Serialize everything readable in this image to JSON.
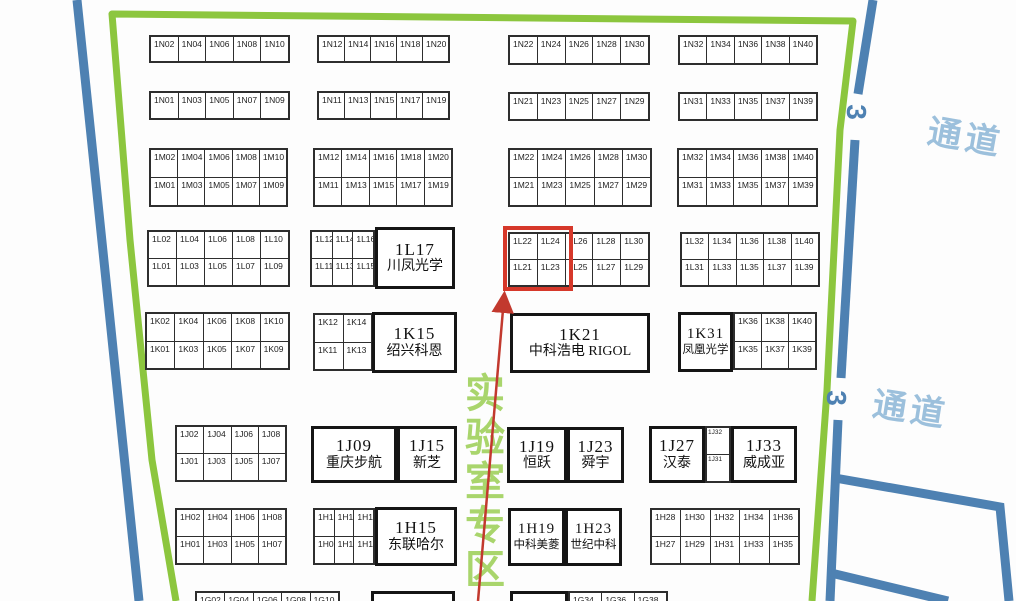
{
  "colors": {
    "border_green": "#8CC63E",
    "zone_green": "#A9D56C",
    "aisle_blue": "#4E81B2",
    "aisle_text_blue": "#9CC0DC",
    "highlight_red": "#D6382A",
    "arrow_red": "#C2392E",
    "booth_border": "#2E2E2E"
  },
  "zone": {
    "text": "实验室专区"
  },
  "aisles": [
    {
      "text": "通道"
    },
    {
      "text": "通道"
    }
  ],
  "gates": [
    {
      "text": "3"
    },
    {
      "text": "3"
    }
  ],
  "highlight": {
    "booths": [
      "1L21",
      "1L22",
      "1L23",
      "1L24"
    ]
  },
  "blocks": [
    {
      "x": 149,
      "y": 35,
      "w": 141,
      "h": 28,
      "rows": [
        [
          "1N02",
          "1N04",
          "1N06",
          "1N08",
          "1N10"
        ]
      ]
    },
    {
      "x": 317,
      "y": 35,
      "w": 133,
      "h": 28,
      "rows": [
        [
          "1N12",
          "1N14",
          "1N16",
          "1N18",
          "1N20"
        ]
      ]
    },
    {
      "x": 508,
      "y": 35,
      "w": 142,
      "h": 30,
      "rows": [
        [
          "1N22",
          "1N24",
          "1N26",
          "1N28",
          "1N30"
        ]
      ]
    },
    {
      "x": 678,
      "y": 35,
      "w": 140,
      "h": 30,
      "rows": [
        [
          "1N32",
          "1N34",
          "1N36",
          "1N38",
          "1N40"
        ]
      ]
    },
    {
      "x": 149,
      "y": 91,
      "w": 141,
      "h": 29,
      "rows": [
        [
          "1N01",
          "1N03",
          "1N05",
          "1N07",
          "1N09"
        ]
      ]
    },
    {
      "x": 317,
      "y": 91,
      "w": 133,
      "h": 29,
      "rows": [
        [
          "1N11",
          "1N13",
          "1N15",
          "1N17",
          "1N19"
        ]
      ]
    },
    {
      "x": 508,
      "y": 92,
      "w": 142,
      "h": 29,
      "rows": [
        [
          "1N21",
          "1N23",
          "1N25",
          "1N27",
          "1N29"
        ]
      ]
    },
    {
      "x": 678,
      "y": 92,
      "w": 140,
      "h": 29,
      "rows": [
        [
          "1N31",
          "1N33",
          "1N35",
          "1N37",
          "1N39"
        ]
      ]
    },
    {
      "x": 149,
      "y": 148,
      "w": 139,
      "h": 59,
      "rows": [
        [
          "1M02",
          "1M04",
          "1M06",
          "1M08",
          "1M10"
        ],
        [
          "1M01",
          "1M03",
          "1M05",
          "1M07",
          "1M09"
        ]
      ]
    },
    {
      "x": 313,
      "y": 148,
      "w": 140,
      "h": 59,
      "rows": [
        [
          "1M12",
          "1M14",
          "1M16",
          "1M18",
          "1M20"
        ],
        [
          "1M11",
          "1M13",
          "1M15",
          "1M17",
          "1M19"
        ]
      ]
    },
    {
      "x": 508,
      "y": 148,
      "w": 144,
      "h": 59,
      "rows": [
        [
          "1M22",
          "1M24",
          "1M26",
          "1M28",
          "1M30"
        ],
        [
          "1M21",
          "1M23",
          "1M25",
          "1M27",
          "1M29"
        ]
      ]
    },
    {
      "x": 677,
      "y": 148,
      "w": 141,
      "h": 59,
      "rows": [
        [
          "1M32",
          "1M34",
          "1M36",
          "1M38",
          "1M40"
        ],
        [
          "1M31",
          "1M33",
          "1M35",
          "1M37",
          "1M39"
        ]
      ]
    },
    {
      "x": 147,
      "y": 230,
      "w": 143,
      "h": 57,
      "rows": [
        [
          "1L02",
          "1L04",
          "1L06",
          "1L08",
          "1L10"
        ],
        [
          "1L01",
          "1L03",
          "1L05",
          "1L07",
          "1L09"
        ]
      ]
    },
    {
      "x": 310,
      "y": 230,
      "w": 65,
      "h": 57,
      "rows": [
        [
          "1L12",
          "1L14",
          "1L16"
        ],
        [
          "1L11",
          "1L13",
          "1L15"
        ]
      ]
    },
    {
      "x": 508,
      "y": 232,
      "w": 142,
      "h": 55,
      "rows": [
        [
          "1L22",
          "1L24",
          "1L26",
          "1L28",
          "1L30"
        ],
        [
          "1L21",
          "1L23",
          "1L25",
          "1L27",
          "1L29"
        ]
      ]
    },
    {
      "x": 680,
      "y": 232,
      "w": 140,
      "h": 55,
      "rows": [
        [
          "1L32",
          "1L34",
          "1L36",
          "1L38",
          "1L40"
        ],
        [
          "1L31",
          "1L33",
          "1L35",
          "1L37",
          "1L39"
        ]
      ]
    },
    {
      "x": 145,
      "y": 312,
      "w": 145,
      "h": 58,
      "rows": [
        [
          "1K02",
          "1K04",
          "1K06",
          "1K08",
          "1K10"
        ],
        [
          "1K01",
          "1K03",
          "1K05",
          "1K07",
          "1K09"
        ]
      ]
    },
    {
      "x": 313,
      "y": 313,
      "w": 60,
      "h": 58,
      "rows": [
        [
          "1K12",
          "1K14"
        ],
        [
          "1K11",
          "1K13"
        ]
      ]
    },
    {
      "x": 733,
      "y": 312,
      "w": 84,
      "h": 58,
      "rows": [
        [
          "1K36",
          "1K38",
          "1K40"
        ],
        [
          "1K35",
          "1K37",
          "1K39"
        ]
      ]
    },
    {
      "x": 175,
      "y": 425,
      "w": 112,
      "h": 57,
      "rows": [
        [
          "1J02",
          "1J04",
          "1J06",
          "1J08"
        ],
        [
          "1J01",
          "1J03",
          "1J05",
          "1J07"
        ]
      ]
    },
    {
      "x": 705,
      "y": 426,
      "w": 26,
      "h": 57,
      "small": true,
      "rows": [
        [
          "1J32"
        ],
        [
          "1J31"
        ]
      ]
    },
    {
      "x": 175,
      "y": 508,
      "w": 112,
      "h": 57,
      "rows": [
        [
          "1H02",
          "1H04",
          "1H06",
          "1H08"
        ],
        [
          "1H01",
          "1H03",
          "1H05",
          "1H07"
        ]
      ]
    },
    {
      "x": 313,
      "y": 508,
      "w": 62,
      "h": 57,
      "rows": [
        [
          "1H10",
          "1H12",
          "1H14"
        ],
        [
          "1H09",
          "1H11",
          "1H13"
        ]
      ]
    },
    {
      "x": 650,
      "y": 508,
      "w": 150,
      "h": 57,
      "rows": [
        [
          "1H28",
          "1H30",
          "1H32",
          "1H34",
          "1H36"
        ],
        [
          "1H27",
          "1H29",
          "1H31",
          "1H33",
          "1H35"
        ]
      ]
    },
    {
      "x": 195,
      "y": 591,
      "w": 145,
      "h": 40,
      "rows": [
        [
          "1G02",
          "1G04",
          "1G06",
          "1G08",
          "1G10"
        ]
      ]
    },
    {
      "x": 568,
      "y": 591,
      "w": 100,
      "h": 40,
      "rows": [
        [
          "1G34",
          "1G36",
          "1G38"
        ]
      ]
    }
  ],
  "big_booths": [
    {
      "x": 375,
      "y": 227,
      "w": 80,
      "h": 62,
      "code": "1L17",
      "name": "川凤光学"
    },
    {
      "x": 372,
      "y": 312,
      "w": 85,
      "h": 61,
      "code": "1K15",
      "name": "绍兴科恩"
    },
    {
      "x": 510,
      "y": 313,
      "w": 140,
      "h": 60,
      "code": "1K21",
      "name": "中科浩电 RIGOL"
    },
    {
      "x": 678,
      "y": 312,
      "w": 55,
      "h": 60,
      "narrow": true,
      "code": "1K31",
      "name": "凤凰光学"
    },
    {
      "x": 311,
      "y": 426,
      "w": 86,
      "h": 57,
      "code": "1J09",
      "name": "重庆步航"
    },
    {
      "x": 397,
      "y": 426,
      "w": 60,
      "h": 57,
      "code": "1J15",
      "name": "新芝"
    },
    {
      "x": 507,
      "y": 427,
      "w": 60,
      "h": 56,
      "code": "1J19",
      "name": "恒跃"
    },
    {
      "x": 567,
      "y": 427,
      "w": 57,
      "h": 56,
      "code": "1J23",
      "name": "舜宇"
    },
    {
      "x": 649,
      "y": 426,
      "w": 56,
      "h": 57,
      "code": "1J27",
      "name": "汉泰"
    },
    {
      "x": 731,
      "y": 426,
      "w": 66,
      "h": 57,
      "code": "1J33",
      "name": "威成亚"
    },
    {
      "x": 375,
      "y": 507,
      "w": 82,
      "h": 59,
      "code": "1H15",
      "name": "东联哈尔"
    },
    {
      "x": 508,
      "y": 508,
      "w": 57,
      "h": 58,
      "narrow": true,
      "code": "1H19",
      "name": "中科美菱"
    },
    {
      "x": 565,
      "y": 508,
      "w": 57,
      "h": 58,
      "narrow": true,
      "code": "1H23",
      "name": "世纪中科"
    },
    {
      "x": 371,
      "y": 591,
      "w": 84,
      "h": 40,
      "code": "",
      "name": ""
    },
    {
      "x": 510,
      "y": 591,
      "w": 58,
      "h": 40,
      "code": "",
      "name": ""
    }
  ]
}
